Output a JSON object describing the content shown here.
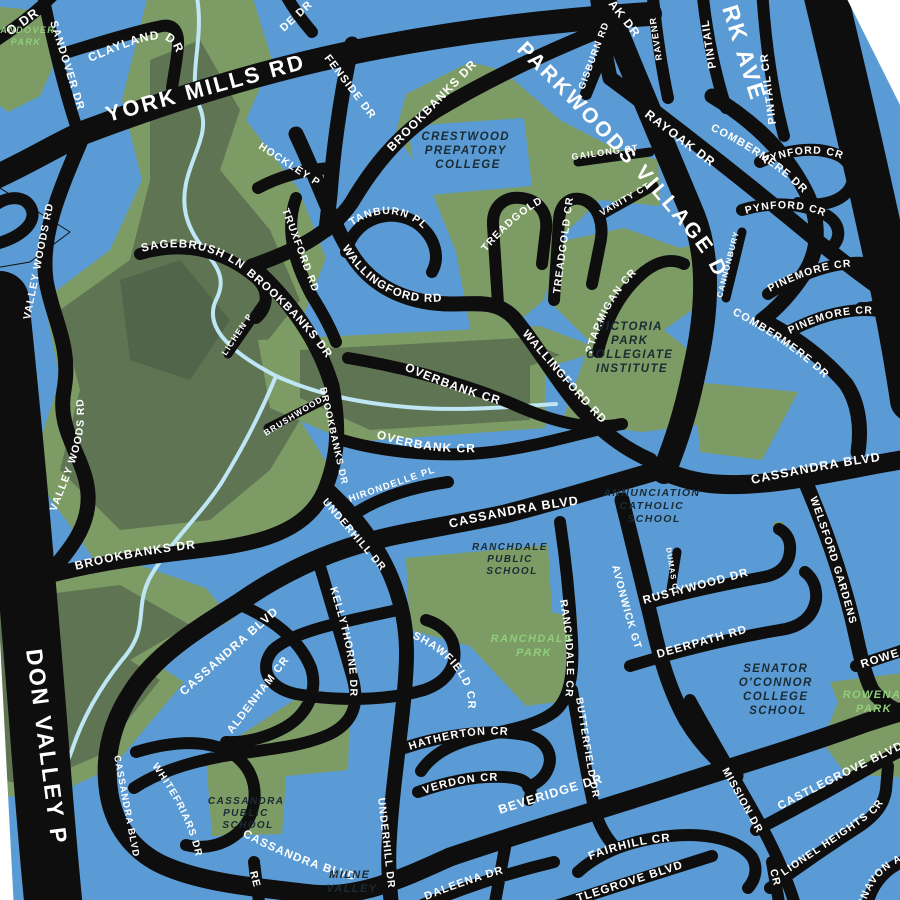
{
  "colors": {
    "background_water": "#5B9BD5",
    "road": "#0E0E0E",
    "park_green": "#7D9B64",
    "forest_green": "#5E7453",
    "deep_forest_green": "#50654A",
    "stream": "#BFE6F5",
    "road_label": "#FFFFFF",
    "school_label": "#1A2B33",
    "park_label": "#8FCE7B",
    "map_edge": "#FFFFFF"
  },
  "roads": {
    "york_mills": "YORK MILLS RD",
    "parkwoods_village": "PARKWOODS VILLAGE DR",
    "sandover": "SANDOVER DR",
    "clayland": "CLAYLAND DR",
    "fenside": "FENSIDE DR",
    "hockley": "HOCKLEY PL",
    "brookbanks": "BROOKBANKS DR",
    "truxford": "TRUXFORD RD",
    "tanburn": "TANBURN PL",
    "sagebrush": "SAGEBRUSH LN",
    "lichen": "LICHEN PL",
    "valley_woods": "VALLEY WOODS RD",
    "wallingford": "WALLINGFORD RD",
    "treadgold": "TREADGOLD CR",
    "ptarmigan": "PTARMIGAN CR",
    "gisburn": "GISBURN RD",
    "rayoak": "RAYOAK DR",
    "pintail": "PINTAIL",
    "pintail_cr": "PINTAIL CR",
    "combermere": "COMBERMERE DR",
    "pynford": "PYNFORD CR",
    "pinemore": "PINEMORE CR",
    "cannonbury": "CANNONBURY CT",
    "gailong": "GAILONG CT",
    "vanity": "VANITY CT",
    "overbank": "OVERBANK CR",
    "brushwood": "BRUSHWOOD CT",
    "hirondelle": "HIRONDELLE PL",
    "underhill": "UNDERHILL DR",
    "cassandra": "CASSANDRA BLVD",
    "welsford": "WELSFORD GARDENS",
    "dumas": "DUMAS CT",
    "rustywood": "RUSTYWOOD DR",
    "deerpath": "DEERPATH RD",
    "avonwick": "AVONWICK GT",
    "ranchdale_cr": "RANCHDALE CR",
    "shawfield": "SHAWFIELD CR",
    "kellythorne": "KELLYTHORNE DR",
    "aldenham": "ALDENHAM CR",
    "whitefriars": "WHITEFRIARS DR",
    "hatherton": "HATHERTON CR",
    "verdon": "VERDON CR",
    "butterfield": "BUTTERFIELD DR",
    "beveridge": "BEVERIDGE DR",
    "fairhill": "FAIRHILL CR",
    "daleena": "DALEENA DR",
    "mission": "MISSION DR",
    "castlegrove": "CASTLEGROVE BLVD",
    "lionel_heights": "LIONEL HEIGHTS CR"
  },
  "fragments": {
    "victoria_park": "RK AVE",
    "don_valley": "DON VALLEY P",
    "o_dr": "O DR",
    "de_dr": "DE DR",
    "ak_dr": "AK DR",
    "ravenr": "RAVENR",
    "rowena": "ROWE",
    "re": "RE",
    "cr": "CR",
    "unavon": "UNAVON A",
    "castlegrove_south": "TLEGROVE BLVD"
  },
  "places": {
    "sandover_park": {
      "lines": [
        "SANDOVER",
        "PARK"
      ]
    },
    "crestwood": {
      "lines": [
        "CRESTWOOD",
        "PREPATORY",
        "COLLEGE"
      ]
    },
    "victoria_park_ci": {
      "lines": [
        "VICTORIA",
        "PARK",
        "COLLEGIATE",
        "INSTITUTE"
      ]
    },
    "annunciation": {
      "lines": [
        "ANNUNCIATION",
        "CATHOLIC",
        "SCHOOL"
      ]
    },
    "ranchdale_ps": {
      "lines": [
        "RANCHDALE",
        "PUBLIC",
        "SCHOOL"
      ]
    },
    "ranchdale_park": {
      "lines": [
        "RANCHDALE",
        "PARK"
      ]
    },
    "cassandra_ps": {
      "lines": [
        "CASSANDRA",
        "PUBLIC",
        "SCHOOL"
      ]
    },
    "senator_oconnor": {
      "lines": [
        "SENATOR",
        "O'CONNOR",
        "COLLEGE",
        "SCHOOL"
      ]
    },
    "rowena_park": {
      "lines": [
        "ROWENA",
        "PARK"
      ]
    },
    "milne_valley": {
      "lines": [
        "MILNE",
        "VALLEY"
      ]
    }
  }
}
